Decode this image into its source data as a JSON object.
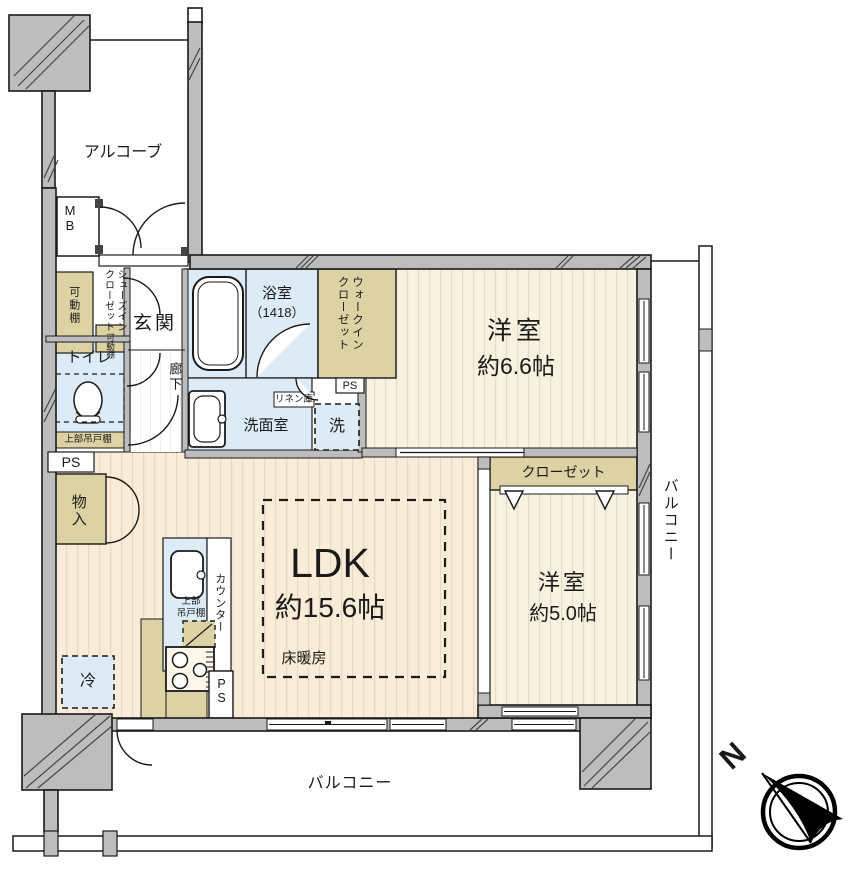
{
  "plan": {
    "colors": {
      "wall_gray": "#bdbdbd",
      "closet_tan": "#dcd2a4",
      "wet_area_blue": "#dcebf5",
      "ldk_cream": "#f9ecd9",
      "bedroom_cream": "#f8f2e1",
      "line_black": "#1a1a1a"
    },
    "exterior": {
      "alcove": "アルコーブ",
      "meter_box": "MB",
      "balcony_right": "バルコニー",
      "balcony_bottom": "バルコニー"
    },
    "entrance": {
      "genkan": "玄関",
      "hallway": "廊下",
      "shoes_closet": "シューズインクローゼット",
      "movable_shelf": "可動棚",
      "movable_shelf_small": "可動棚"
    },
    "toilet": {
      "name": "トイレ",
      "upper_cabinet": "上部吊戸棚",
      "pipe_space": "PS"
    },
    "storage": {
      "name": "物入"
    },
    "bath": {
      "name": "浴室",
      "size": "（1418）"
    },
    "wic": {
      "name": "ウォークインクローゼット",
      "pipe_space": "PS"
    },
    "washroom": {
      "name": "洗面室",
      "linen": "リネン庫",
      "washer": "洗"
    },
    "bedroom1": {
      "name": "洋室",
      "size": "約6.6帖"
    },
    "bedroom2": {
      "name": "洋室",
      "size": "約5.0帖",
      "closet": "クローゼット"
    },
    "ldk": {
      "name": "LDK",
      "size": "約15.6帖",
      "floor_heating": "床暖房"
    },
    "kitchen": {
      "counter": "カウンター",
      "upper_cabinet": "上部\n吊戸棚",
      "pipe_space": "PS",
      "fridge": "冷"
    },
    "compass": {
      "north": "N"
    }
  }
}
